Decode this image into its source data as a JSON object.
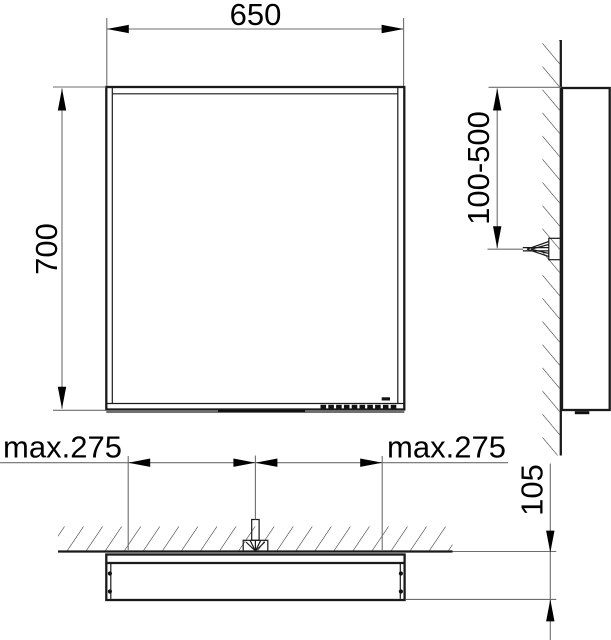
{
  "drawing": {
    "type": "installation dimension drawing",
    "views": {
      "front": {
        "width_dim": "650",
        "height_dim": "700"
      },
      "side": {
        "mount_range_dim": "100-500"
      },
      "plan": {
        "left_max_dim": "max.275",
        "right_max_dim": "max.275",
        "depth_dim": "105"
      }
    },
    "colors": {
      "object_line": "#1a1a1a",
      "dimension_line": "#6e6e6e",
      "hatch_line": "#2b2b2b",
      "arrow_fill": "#000000",
      "background": "#ffffff"
    }
  }
}
